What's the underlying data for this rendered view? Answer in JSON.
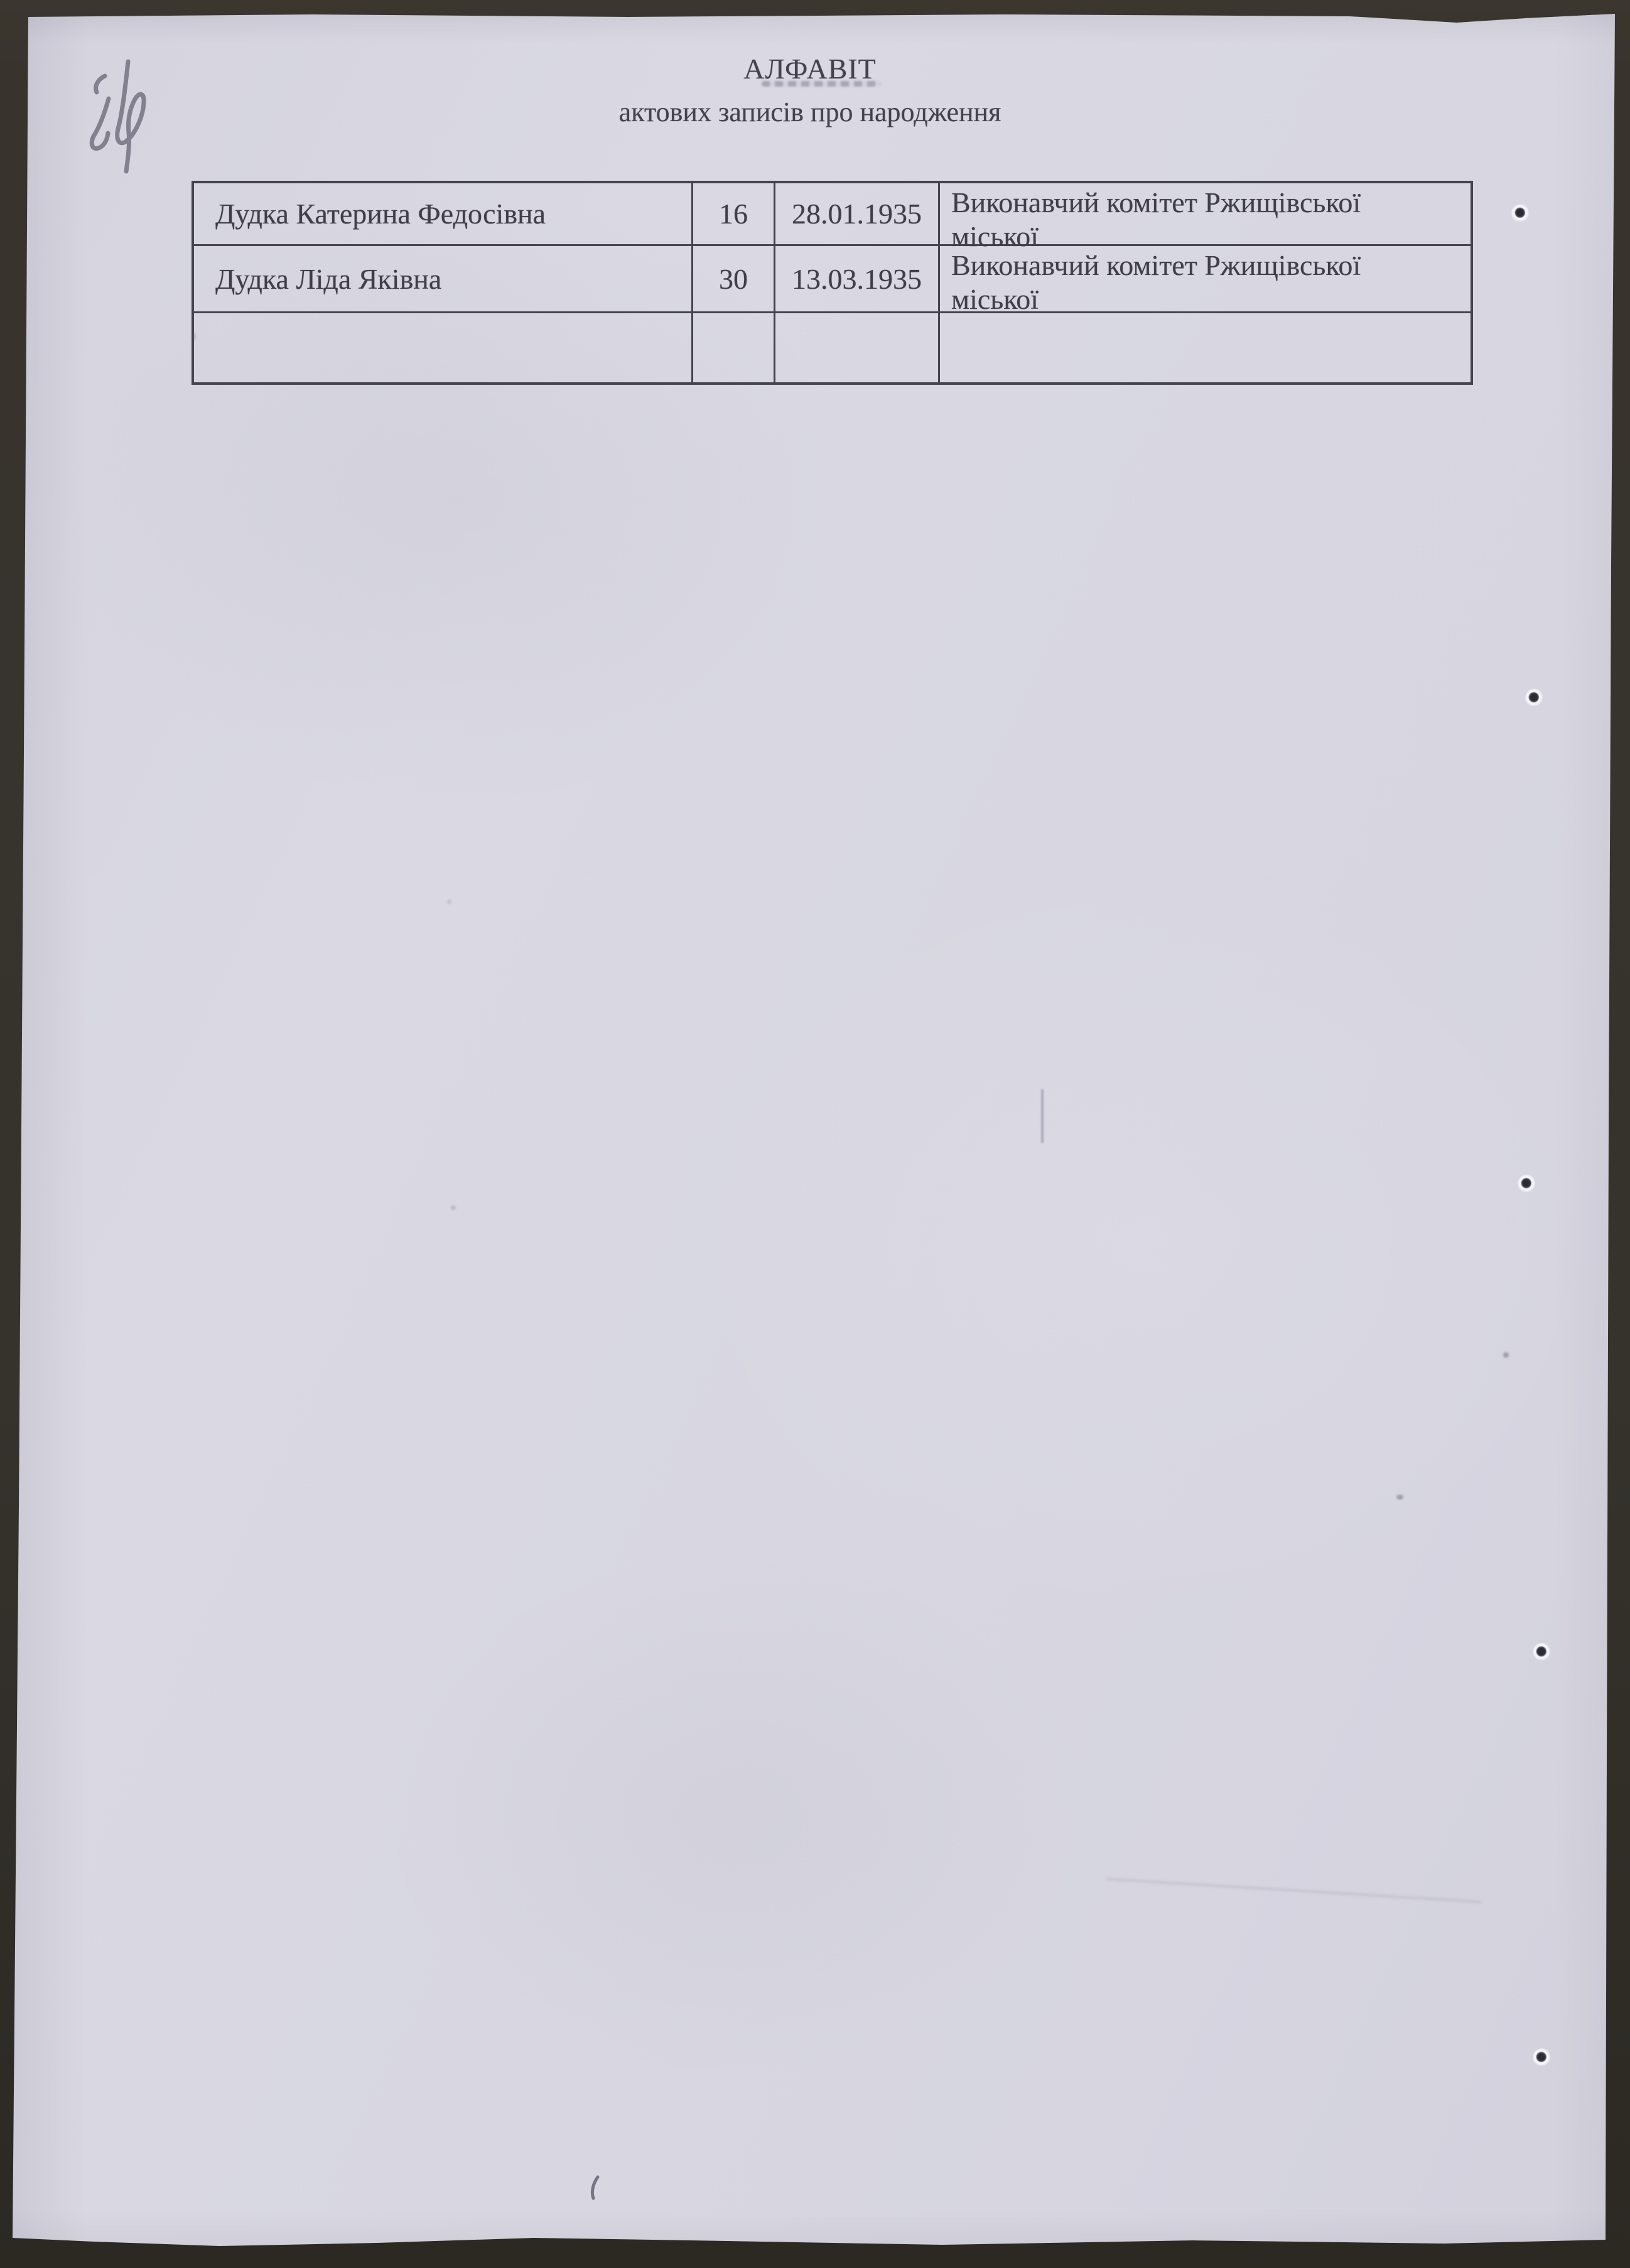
{
  "document": {
    "title": "АЛФАВІТ",
    "subtitle": "актових записів про народження"
  },
  "table": {
    "rows": [
      {
        "name": "Дудка Катерина Федосівна",
        "record_number": "16",
        "date": "28.01.1935",
        "office": "Виконавчий комітет Ржищівської міської"
      },
      {
        "name": "Дудка Ліда Яківна",
        "record_number": "30",
        "date": "13.03.1935",
        "office": "Виконавчий комітет Ржищівської міської"
      },
      {
        "name": "",
        "record_number": "",
        "date": "",
        "office": ""
      }
    ]
  },
  "colors": {
    "paper": "#d8d7e1",
    "ink": "#44424e",
    "table_border": "#45434e",
    "scan_background": "#34312c"
  }
}
